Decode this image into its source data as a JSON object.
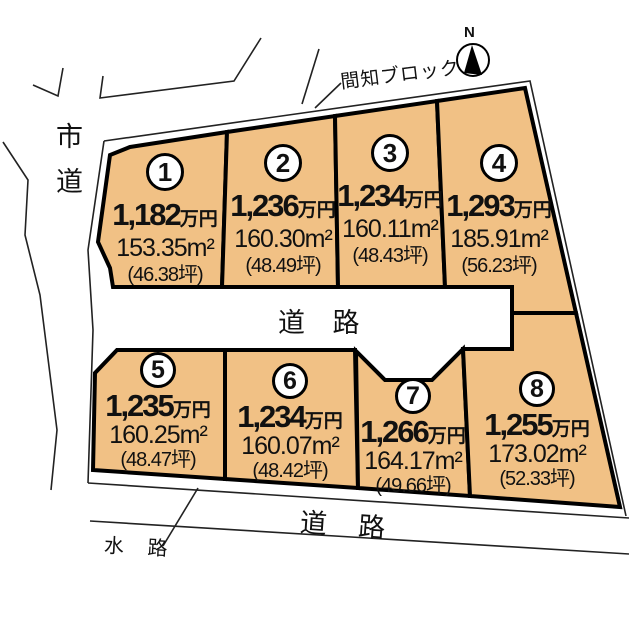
{
  "labels": {
    "north": "N",
    "masonry_block": "間知ブロック",
    "city_road": "市道",
    "center_road": "道 路",
    "bottom_road": "道 路",
    "waterway": "水 路"
  },
  "colors": {
    "plot_fill": "#F1C185",
    "outline": "#000000",
    "background": "#FFFFFF"
  },
  "plots": [
    {
      "number": "1",
      "price": "1,182",
      "price_unit": "万円",
      "area": "153.35m²",
      "tsubo": "(46.38坪)"
    },
    {
      "number": "2",
      "price": "1,236",
      "price_unit": "万円",
      "area": "160.30m²",
      "tsubo": "(48.49坪)"
    },
    {
      "number": "3",
      "price": "1,234",
      "price_unit": "万円",
      "area": "160.11m²",
      "tsubo": "(48.43坪)"
    },
    {
      "number": "4",
      "price": "1,293",
      "price_unit": "万円",
      "area": "185.91m²",
      "tsubo": "(56.23坪)"
    },
    {
      "number": "5",
      "price": "1,235",
      "price_unit": "万円",
      "area": "160.25m²",
      "tsubo": "(48.47坪)"
    },
    {
      "number": "6",
      "price": "1,234",
      "price_unit": "万円",
      "area": "160.07m²",
      "tsubo": "(48.42坪)"
    },
    {
      "number": "7",
      "price": "1,266",
      "price_unit": "万円",
      "area": "164.17m²",
      "tsubo": "(49.66坪)"
    },
    {
      "number": "8",
      "price": "1,255",
      "price_unit": "万円",
      "area": "173.02m²",
      "tsubo": "(52.33坪)"
    }
  ]
}
